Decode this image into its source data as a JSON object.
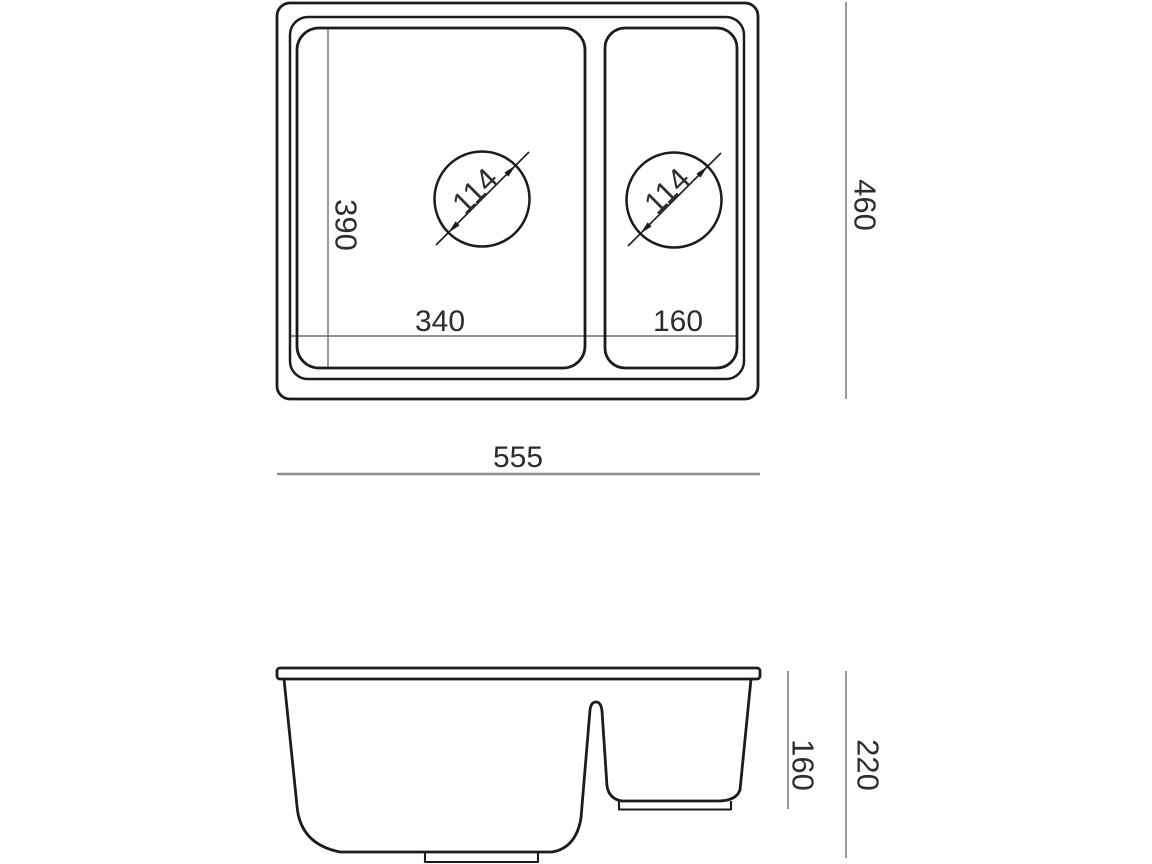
{
  "colors": {
    "background": "#ffffff",
    "outline": "#1c1c1c",
    "dimension_line": "#6e6e6e",
    "dimension_line_light": "#8e8e8e",
    "label_text": "#2d2d2d"
  },
  "top_view": {
    "overall_width": "555",
    "overall_depth": "460",
    "main_bowl_width": "340",
    "main_bowl_depth": "390",
    "half_bowl_width": "160",
    "main_bowl_drain_diameter": "114",
    "half_bowl_drain_diameter": "114"
  },
  "side_view": {
    "overall_height": "220",
    "half_bowl_depth": "160"
  }
}
